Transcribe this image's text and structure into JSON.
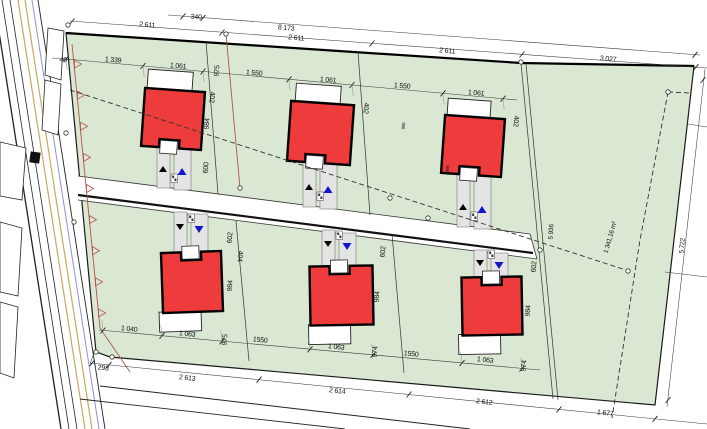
{
  "plot": {
    "area_label": "1 341,16 m²"
  },
  "colors": {
    "plot_green": "#d9e7d3",
    "house_red": "#ee3b3b",
    "house_outline": "#000000",
    "garage_white": "#ffffff",
    "driveway_gray": "#e4e4e4",
    "marker_blue": "#1414cc",
    "marker_black": "#000000",
    "fence_red": "#b3524c",
    "utility_yellow": "#c9a85f",
    "utility_blue": "#9090d8",
    "dim_line": "#3a3a3a",
    "label_ink": "#111111"
  },
  "labels": [
    {
      "t": "340",
      "x": 196,
      "y": 19,
      "r": 5
    },
    {
      "t": "8 173",
      "x": 286,
      "y": 30,
      "r": 5
    },
    {
      "t": "2 611",
      "x": 147,
      "y": 27,
      "r": 5
    },
    {
      "t": "2 611",
      "x": 296,
      "y": 40,
      "r": 5
    },
    {
      "t": "2 611",
      "x": 447,
      "y": 53,
      "r": 5
    },
    {
      "t": "3 027",
      "x": 608,
      "y": 61,
      "r": 5
    },
    {
      "t": "40",
      "x": 63,
      "y": 62,
      "r": 5
    },
    {
      "t": "1 339",
      "x": 113,
      "y": 62,
      "r": 5
    },
    {
      "t": "1 061",
      "x": 178,
      "y": 68,
      "r": 5
    },
    {
      "t": "975",
      "x": 219,
      "y": 71,
      "r": -85
    },
    {
      "t": "1 550",
      "x": 254,
      "y": 75,
      "r": 5
    },
    {
      "t": "1 061",
      "x": 328,
      "y": 82,
      "r": 5
    },
    {
      "t": "1 550",
      "x": 402,
      "y": 88,
      "r": 5
    },
    {
      "t": "1 061",
      "x": 476,
      "y": 95,
      "r": 5
    },
    {
      "t": "402",
      "x": 210,
      "y": 97,
      "r": 95
    },
    {
      "t": "984",
      "x": 209,
      "y": 124,
      "r": -85
    },
    {
      "t": "600",
      "x": 208,
      "y": 168,
      "r": -85
    },
    {
      "t": "402",
      "x": 364,
      "y": 108,
      "r": 95
    },
    {
      "t": "402",
      "x": 514,
      "y": 121,
      "r": 95
    },
    {
      "t": "985",
      "x": 405,
      "y": 126,
      "r": -85,
      "s": 4.5
    },
    {
      "t": "985",
      "x": 449,
      "y": 169,
      "r": -85,
      "s": 4.5
    },
    {
      "t": "602",
      "x": 232,
      "y": 238,
      "r": -85
    },
    {
      "t": "404",
      "x": 238,
      "y": 256,
      "r": 95
    },
    {
      "t": "984",
      "x": 232,
      "y": 286,
      "r": -85
    },
    {
      "t": "602",
      "x": 385,
      "y": 252,
      "r": -85
    },
    {
      "t": "984",
      "x": 379,
      "y": 297,
      "r": -85
    },
    {
      "t": "602",
      "x": 536,
      "y": 267,
      "r": -85
    },
    {
      "t": "984",
      "x": 530,
      "y": 311,
      "r": -85
    },
    {
      "t": "5 936",
      "x": 553,
      "y": 232,
      "r": -86,
      "s": 6.5
    },
    {
      "t": "1 341,16 m²",
      "x": 612,
      "y": 238,
      "r": -74,
      "s": 6.5
    },
    {
      "t": "5 722",
      "x": 684,
      "y": 246,
      "r": -85,
      "s": 6.5
    },
    {
      "t": "1 040",
      "x": 129,
      "y": 331,
      "r": 6
    },
    {
      "t": "1 063",
      "x": 187,
      "y": 336,
      "r": 6
    },
    {
      "t": "975",
      "x": 227,
      "y": 340,
      "r": -85
    },
    {
      "t": "1550",
      "x": 260,
      "y": 342,
      "r": 6
    },
    {
      "t": "1 063",
      "x": 336,
      "y": 349,
      "r": 6
    },
    {
      "t": "974",
      "x": 377,
      "y": 352,
      "r": -85
    },
    {
      "t": "1550",
      "x": 411,
      "y": 356,
      "r": 6
    },
    {
      "t": "1 063",
      "x": 485,
      "y": 362,
      "r": 6
    },
    {
      "t": "974",
      "x": 526,
      "y": 366,
      "r": -85
    },
    {
      "t": "298",
      "x": 103,
      "y": 370,
      "r": 6
    },
    {
      "t": "2 613",
      "x": 187,
      "y": 380,
      "r": 6
    },
    {
      "t": "2 614",
      "x": 337,
      "y": 393,
      "r": 6
    },
    {
      "t": "2 612",
      "x": 484,
      "y": 404,
      "r": 6
    },
    {
      "t": "1 677",
      "x": 605,
      "y": 415,
      "r": 6
    }
  ],
  "houses": [
    {
      "row": "top",
      "x": 143,
      "y": 90,
      "w": 60,
      "h": 58,
      "rot": 4,
      "garage": [
        145,
        71,
        45,
        20
      ],
      "strips": [
        [
          157,
          142,
          13,
          46
        ],
        [
          174,
          142,
          17,
          48
        ]
      ],
      "markers": [
        {
          "x": 163,
          "y": 166,
          "dir": "up",
          "color": "black"
        },
        {
          "x": 182,
          "y": 168,
          "dir": "up",
          "color": "blue"
        }
      ],
      "box": [
        171,
        174
      ]
    },
    {
      "row": "top",
      "x": 289,
      "y": 103,
      "w": 63,
      "h": 60,
      "rot": 4,
      "garage": [
        293,
        85,
        45,
        20
      ],
      "strips": [
        [
          303,
          156,
          13,
          51
        ],
        [
          320,
          156,
          17,
          53
        ]
      ],
      "markers": [
        {
          "x": 309,
          "y": 184,
          "dir": "up",
          "color": "black"
        },
        {
          "x": 328,
          "y": 186,
          "dir": "up",
          "color": "blue"
        }
      ],
      "box": [
        317,
        192
      ]
    },
    {
      "row": "top",
      "x": 443,
      "y": 117,
      "w": 60,
      "h": 58,
      "rot": 4,
      "garage": [
        445,
        100,
        43,
        19
      ],
      "strips": [
        [
          457,
          170,
          13,
          57
        ],
        [
          474,
          170,
          17,
          59
        ]
      ],
      "markers": [
        {
          "x": 463,
          "y": 204,
          "dir": "up",
          "color": "black"
        },
        {
          "x": 482,
          "y": 206,
          "dir": "up",
          "color": "blue"
        }
      ],
      "box": [
        471,
        212
      ]
    },
    {
      "row": "bottom",
      "x": 162,
      "y": 252,
      "w": 60,
      "h": 60,
      "rot": -2,
      "garage": [
        158,
        311,
        42,
        20
      ],
      "strips": [
        [
          174,
          212,
          13,
          48
        ],
        [
          191,
          214,
          17,
          46
        ]
      ],
      "markers": [
        {
          "x": 180,
          "y": 224,
          "dir": "down",
          "color": "black"
        },
        {
          "x": 199,
          "y": 226,
          "dir": "down",
          "color": "blue"
        }
      ],
      "box": [
        188,
        214
      ]
    },
    {
      "row": "bottom",
      "x": 310,
      "y": 266,
      "w": 63,
      "h": 59,
      "rot": -1,
      "garage": [
        308,
        324,
        42,
        20
      ],
      "strips": [
        [
          322,
          230,
          13,
          44
        ],
        [
          339,
          233,
          17,
          41
        ]
      ],
      "markers": [
        {
          "x": 328,
          "y": 241,
          "dir": "down",
          "color": "black"
        },
        {
          "x": 347,
          "y": 243,
          "dir": "down",
          "color": "blue"
        }
      ],
      "box": [
        336,
        231
      ]
    },
    {
      "row": "bottom",
      "x": 462,
      "y": 277,
      "w": 60,
      "h": 58,
      "rot": -1,
      "garage": [
        458,
        334,
        42,
        20
      ],
      "strips": [
        [
          474,
          250,
          13,
          35
        ],
        [
          491,
          253,
          17,
          32
        ]
      ],
      "markers": [
        {
          "x": 480,
          "y": 260,
          "dir": "down",
          "color": "black"
        },
        {
          "x": 499,
          "y": 262,
          "dir": "down",
          "color": "blue"
        }
      ],
      "box": [
        488,
        250
      ]
    }
  ],
  "survey_points": [
    [
      68,
      25
    ],
    [
      226,
      34
    ],
    [
      521,
      62
    ],
    [
      240,
      188
    ],
    [
      390,
      198
    ],
    [
      428,
      218
    ],
    [
      540,
      250
    ],
    [
      96,
      352
    ],
    [
      112,
      357
    ],
    [
      628,
      271
    ],
    [
      668,
      92
    ],
    [
      66,
      133
    ],
    [
      74,
      222
    ]
  ],
  "fence": {
    "start": [
      73,
      48
    ],
    "end": [
      100,
      328
    ],
    "tail": [
      130,
      372
    ],
    "triangle_count": 9
  }
}
